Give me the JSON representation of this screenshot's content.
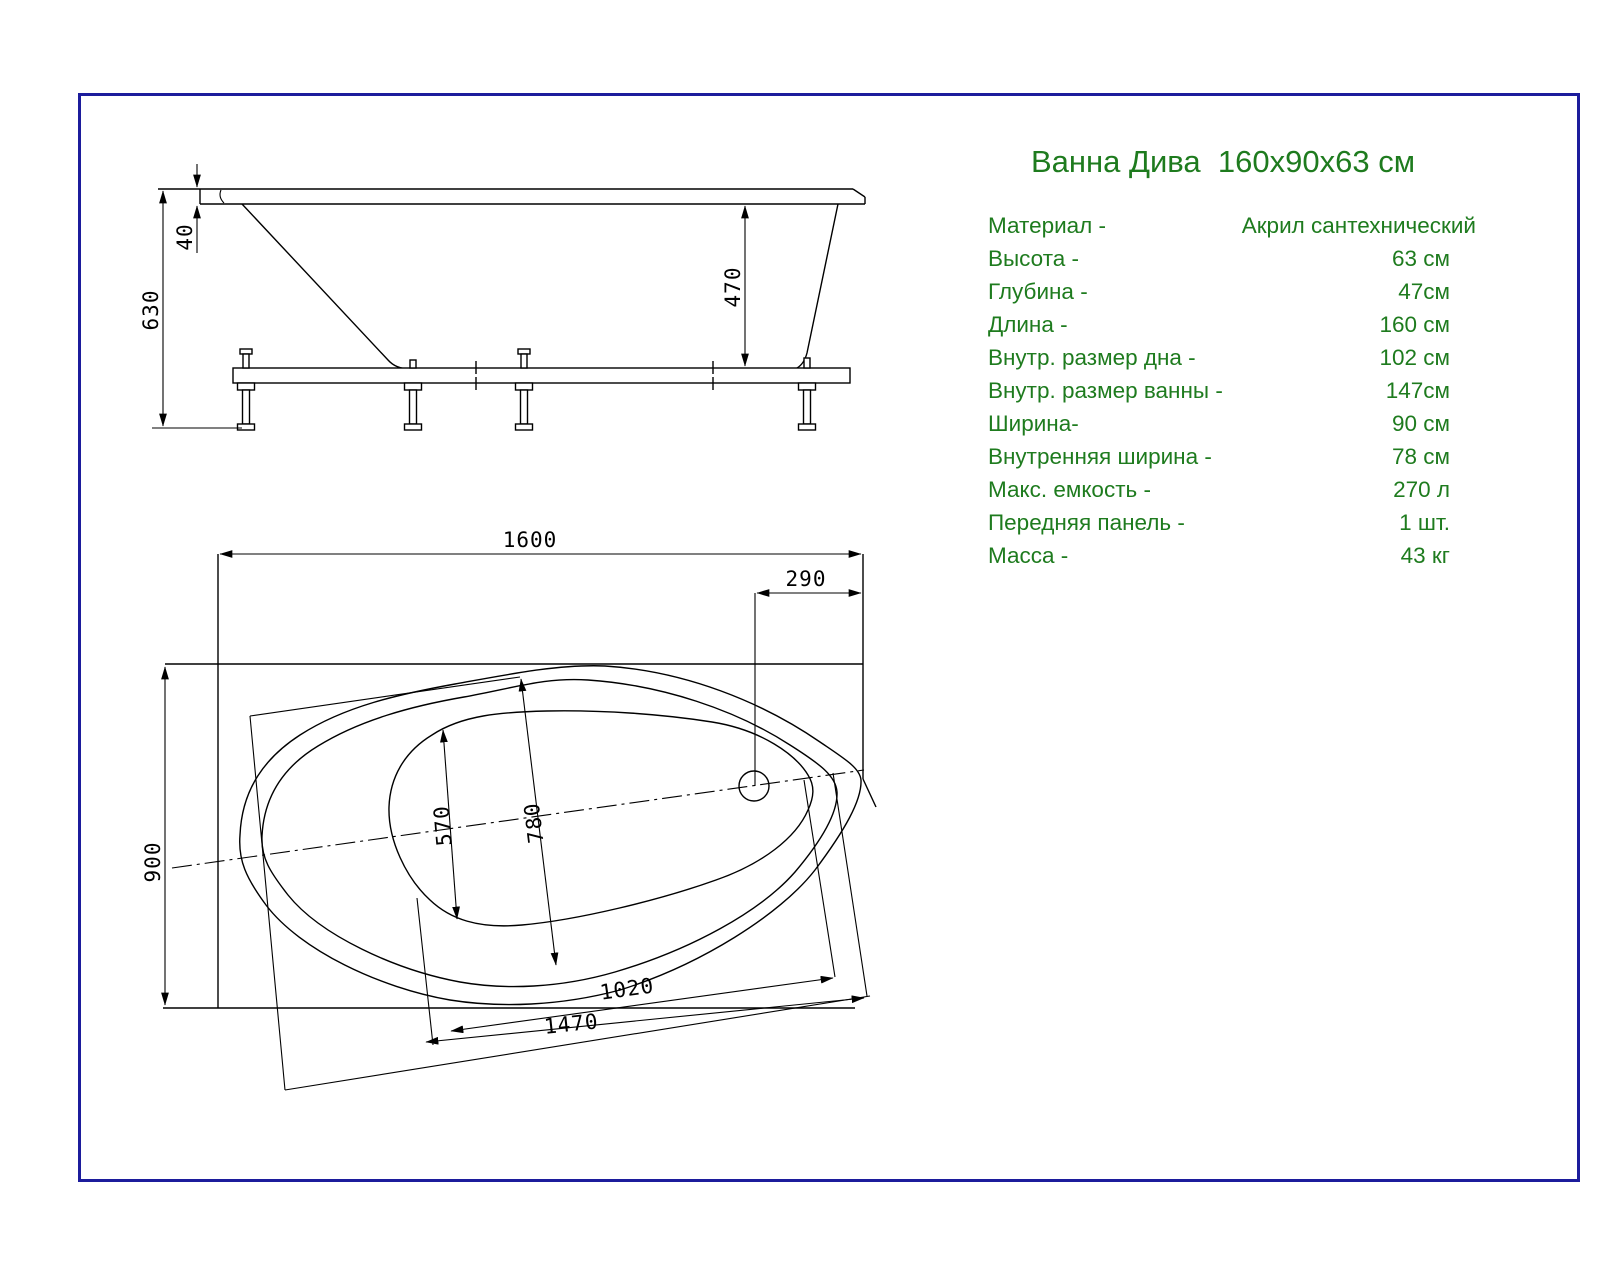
{
  "title": "Ванна Дива  160x90x63 см",
  "colors": {
    "page_border": "#1c1c9c",
    "spec_text": "#1e7b1e",
    "drawing_lines": "#000000"
  },
  "specs": {
    "rows": [
      {
        "label": "Материал -",
        "value": "Акрил сантехнический"
      },
      {
        "label": "Высота -",
        "value": "63 см"
      },
      {
        "label": "Глубина -",
        "value": "47см"
      },
      {
        "label": "Длина -",
        "value": "160 см"
      },
      {
        "label": "Внутр. размер дна -",
        "value": "102 см"
      },
      {
        "label": "Внутр. размер ванны -",
        "value": "147см"
      },
      {
        "label": "Ширина-",
        "value": "90 см"
      },
      {
        "label": "Внутренняя ширина -",
        "value": "78 см"
      },
      {
        "label": "Макс. емкость -",
        "value": "270 л"
      },
      {
        "label": "Передняя панель -",
        "value": "1 шт."
      },
      {
        "label": "Масса -",
        "value": "43 кг"
      }
    ]
  },
  "side_view": {
    "dims": {
      "total_height": "630",
      "rim_thickness": "40",
      "inner_depth": "470"
    }
  },
  "plan_view": {
    "dims": {
      "overall_length": "1600",
      "overall_width": "900",
      "drain_offset": "290",
      "bottom_width": "570",
      "inner_width": "780",
      "bottom_length": "1020",
      "inner_length": "1470"
    }
  }
}
